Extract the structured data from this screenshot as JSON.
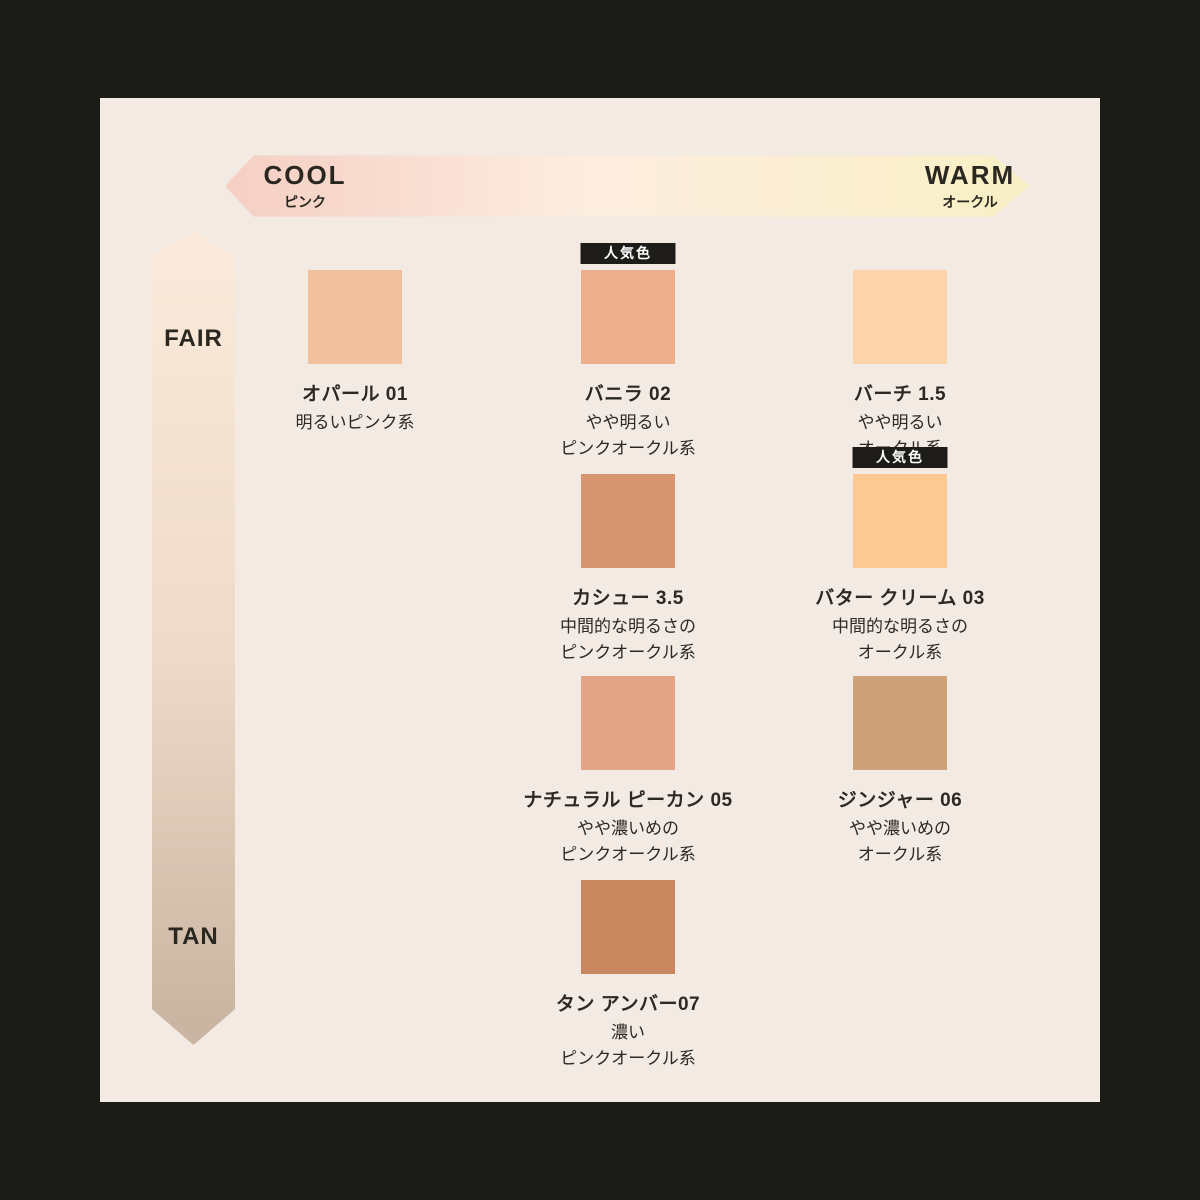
{
  "page": {
    "frame_color": "#1b1b17",
    "panel_color": "#f2eae3",
    "text_color": "#2b2922"
  },
  "badge_label": "人気色",
  "axes": {
    "horizontal": {
      "left_label": "COOL",
      "left_sublabel": "ピンク",
      "right_label": "WARM",
      "right_sublabel": "オークル",
      "gradient": [
        "#f6d0c4",
        "#fcede0",
        "#f9efc6"
      ]
    },
    "vertical": {
      "top_label": "FAIR",
      "bottom_label": "TAN",
      "gradient": [
        "#fae9da",
        "#eedac8",
        "#c9b5a1"
      ]
    }
  },
  "shades": [
    {
      "name": "オパール 01",
      "desc": "明るいピンク系",
      "color": "#f2bf9f",
      "popular": false
    },
    {
      "name": "バニラ 02",
      "desc": "やや明るい\nピンクオークル系",
      "color": "#ecb18c",
      "popular": true
    },
    {
      "name": "バーチ 1.5",
      "desc": "やや明るい\nオークル系",
      "color": "#fbd4ab",
      "popular": false
    },
    {
      "name": "カシュー 3.5",
      "desc": "中間的な明るさの\nピンクオークル系",
      "color": "#d69470",
      "popular": false
    },
    {
      "name": "バター クリーム 03",
      "desc": "中間的な明るさの\nオークル系",
      "color": "#fcc994",
      "popular": true
    },
    {
      "name": "ナチュラル ピーカン 05",
      "desc": "やや濃いめの\nピンクオークル系",
      "color": "#e2a484",
      "popular": false
    },
    {
      "name": "ジンジャー 06",
      "desc": "やや濃いめの\nオークル系",
      "color": "#cfa179",
      "popular": false
    },
    {
      "name": "タン アンバー07",
      "desc": "濃い\nピンクオークル系",
      "color": "#c9875f",
      "popular": false
    }
  ]
}
